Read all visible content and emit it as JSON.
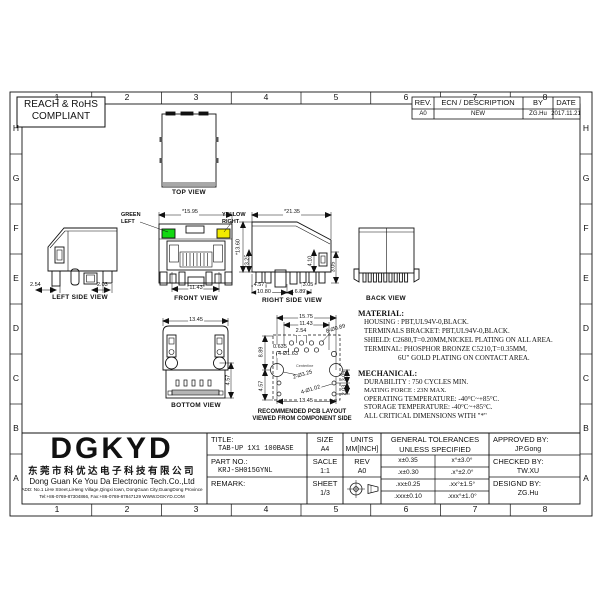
{
  "grid": {
    "cols": [
      "1",
      "2",
      "3",
      "4",
      "5",
      "6",
      "7",
      "8"
    ],
    "rows": [
      "H",
      "G",
      "F",
      "E",
      "D",
      "C",
      "B",
      "A"
    ]
  },
  "compliance": {
    "line1": "REACH & RoHS",
    "line2": "COMPLIANT"
  },
  "revision_table": {
    "headers": {
      "rev": "REV.",
      "ecn": "ECN / DESCRIPTION",
      "by": "BY",
      "date": "DATE"
    },
    "row": {
      "rev": "A0",
      "ecn": "NEW",
      "by": "ZG.Hu",
      "date": "2017.11.21"
    }
  },
  "views": {
    "top": {
      "label": "TOP VIEW"
    },
    "left_side": {
      "label": "LEFT SIDE VIEW",
      "dims": {
        "d1": "2.54",
        "d2": "2.03"
      }
    },
    "front": {
      "label": "FRONT VIEW",
      "led_left_l1": "GREEN",
      "led_left_l2": "LEFT",
      "led_right_l1": "YELLOW",
      "led_right_l2": "RIGHT",
      "dims": {
        "width_top": "*15.95",
        "width_bottom": "11.43"
      }
    },
    "right_side": {
      "label": "RIGHT SIDE VIEW",
      "dims": {
        "w": "*21.35",
        "h1": "*13.60",
        "h2": "*3.25",
        "m1": "4.10",
        "r1": "3.05",
        "b1": "4.57",
        "b2": "3.05",
        "b3": "10.80",
        "b4": "6.89"
      }
    },
    "back": {
      "label": "BACK VIEW"
    },
    "bottom": {
      "label": "BOTTOM VIEW",
      "dims": {
        "w": "13.45",
        "r1": "4.57"
      }
    },
    "pcb": {
      "caption1": "RECOMMENDED PCB LAYOUT",
      "caption2": "VIEWED FROM COMPONENT SIDE",
      "dims": {
        "t1": "15.75",
        "t2": "11.43",
        "t3": "2.54",
        "holes8": "8-Ø0.89",
        "l1": "8.89",
        "l2": "4.57",
        "i1": "0.635",
        "i2": "4-Ø1.63",
        "centerline": "Centerline",
        "mount": "2-Ø3.25",
        "holes4": "4-Ø1.02",
        "r1": "3.05",
        "r2": "2.03",
        "b1": "13.45"
      }
    }
  },
  "material": {
    "header": "MATERIAL:",
    "lines": [
      "HOUSING : PBT,UL94V-0,BLACK.",
      "TERMINALS BRACKET: PBT,UL94V-0,BLACK.",
      "SHIELD: C2680,T=0.20MM,NICKEL PLATING ON ALL AREA.",
      "TERMINAL: PHOSPHOR BRONZE C5210,T=0.35MM,",
      "6U\" GOLD PLATING ON CONTACT AREA."
    ]
  },
  "mechanical": {
    "header": "MECHANICAL:",
    "lines": [
      "DURABILITY : 750 CYCLES MIN.",
      "MATING FORCE : 23N MAX.",
      "OPERATING TEMPERATURE: -40°C~+85°C.",
      "STORAGE TEMPERATURE: -40°C~+85°C.",
      "ALL CRITICAL DIMENSIONS WITH \"*\""
    ]
  },
  "title_block": {
    "company": {
      "logo": "DGKYD",
      "name_cn": "东莞市科优达电子科技有限公司",
      "name_en": "Dong Guan Ke You Da Electronic Tech.Co.,Ltd",
      "address": "ADD: No.1 LiHe Street,LiHeng Village,Qingxi town, DongGuan City,GuangDong Province",
      "contact": "Tel:+86-0769-87304866, Fax:+86-0769-87847129 WWW.DGKYD.COM"
    },
    "title_label": "TITLE:",
    "title_value": "TAB-UP 1X1 100BASE",
    "part_no_label": "PART NO.:",
    "part_no_value": "KRJ-SH015GYNL",
    "remark_label": "REMARK:",
    "size_label": "SIZE",
    "size_value": "A4",
    "scale_label": "SACLE",
    "scale_value": "1:1",
    "sheet_label": "SHEET",
    "sheet_value": "1/3",
    "units_label": "UNITS",
    "units_value": "MM[INCH]",
    "rev_label": "REV",
    "rev_value": "A0",
    "tolerances": {
      "header1": "GENERAL TOLERANCES",
      "header2": "UNLESS SPECIFIED",
      "rows": [
        [
          "x±0.35",
          "x°±3.0°"
        ],
        [
          ".x±0.30",
          ".x°±2.0°"
        ],
        [
          ".xx±0.25",
          ".xx°±1.5°"
        ],
        [
          ".xxx±0.10",
          ".xxx°±1.0°"
        ]
      ]
    },
    "approved_label": "APPROVED BY:",
    "approved_value": "JP.Gong",
    "checked_label": "CHECKED BY:",
    "checked_value": "TW.XU",
    "designed_label": "DESIGND BY:",
    "designed_value": "ZG.Hu"
  },
  "colors": {
    "led_green": "#12d812",
    "led_yellow": "#f2ea00",
    "shade_gray": "#a8a8a8"
  }
}
